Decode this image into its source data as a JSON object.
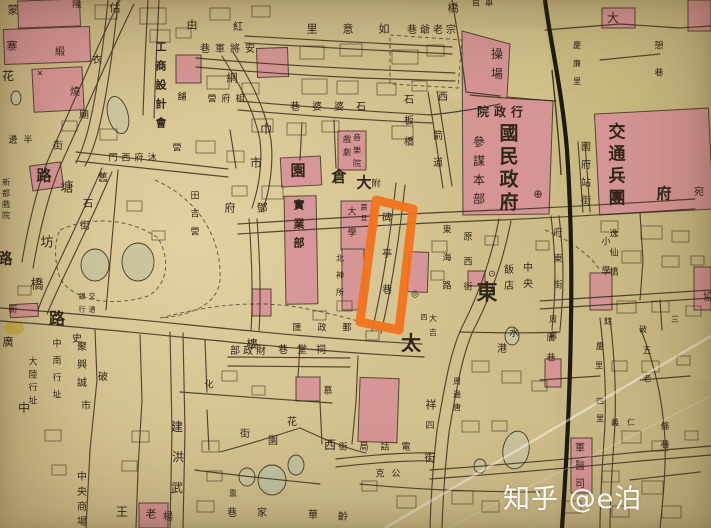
{
  "photo": {
    "kind": "old city map photograph",
    "watermark": {
      "text": "知乎 @e泊",
      "color": "#ffffff"
    }
  },
  "colors": {
    "paper": "#d2c08d",
    "block_pink": "#d98f97",
    "ink": "#30251a",
    "railway": "#1f1a12",
    "highlight": "#f2731d",
    "pond": "#c9c49d"
  },
  "highlight": {
    "shape": "rectangle-outline",
    "color": "#f2731d",
    "points": "376,200 413,209 399,330 360,322",
    "highlights_street": "碑亭巷"
  },
  "labels": [
    {
      "t": "蒙",
      "x": 13,
      "y": 10,
      "s": 11
    },
    {
      "t": "寨",
      "x": 12,
      "y": 46,
      "s": 11
    },
    {
      "t": "花",
      "x": 8,
      "y": 76,
      "s": 12
    },
    {
      "t": "隆",
      "x": 77,
      "y": 5,
      "s": 10
    },
    {
      "t": "緞",
      "x": 60,
      "y": 53,
      "s": 10
    },
    {
      "t": "衣",
      "x": 97,
      "y": 61,
      "s": 10
    },
    {
      "t": "燒",
      "x": 75,
      "y": 93,
      "s": 10
    },
    {
      "t": "廟",
      "x": 84,
      "y": 116,
      "s": 10
    },
    {
      "t": "估",
      "x": 115,
      "y": 8,
      "s": 11
    },
    {
      "t": "由",
      "x": 192,
      "y": 25,
      "s": 11
    },
    {
      "t": "紅",
      "x": 238,
      "y": 28,
      "s": 10
    },
    {
      "t": "里意如",
      "x": 312,
      "y": 29,
      "s": 11,
      "d": "h",
      "st": 36
    },
    {
      "t": "巷爺老宗",
      "x": 412,
      "y": 31,
      "s": 10,
      "d": "h",
      "st": 13
    },
    {
      "t": "橋",
      "x": 453,
      "y": 8,
      "s": 11
    },
    {
      "t": "巷軍將安",
      "x": 205,
      "y": 50,
      "s": 10,
      "d": "h",
      "st": 15
    },
    {
      "t": "舖",
      "x": 182,
      "y": 98,
      "s": 9
    },
    {
      "t": "營府相",
      "x": 212,
      "y": 100,
      "s": 9,
      "d": "h",
      "st": 14
    },
    {
      "t": "工商設計會",
      "x": 161,
      "y": 47,
      "s": 11,
      "d": "v",
      "st": 19,
      "b": 1
    },
    {
      "t": "網",
      "x": 232,
      "y": 78,
      "s": 11
    },
    {
      "t": "巾",
      "x": 266,
      "y": 129,
      "s": 12
    },
    {
      "t": "市",
      "x": 256,
      "y": 163,
      "s": 12
    },
    {
      "t": "門西府沐",
      "x": 113,
      "y": 159,
      "s": 9,
      "d": "h",
      "st": 13
    },
    {
      "t": "營",
      "x": 177,
      "y": 149,
      "s": 9
    },
    {
      "t": "邊半",
      "x": 13,
      "y": 141,
      "s": 9,
      "d": "h",
      "st": 15
    },
    {
      "t": "街",
      "x": 58,
      "y": 147,
      "s": 10
    },
    {
      "t": "路",
      "x": 44,
      "y": 176,
      "s": 15,
      "b": 1
    },
    {
      "t": "塘",
      "x": 67,
      "y": 188,
      "s": 13
    },
    {
      "t": "舊",
      "x": 103,
      "y": 179,
      "s": 10
    },
    {
      "t": "石",
      "x": 88,
      "y": 205,
      "s": 10
    },
    {
      "t": "街",
      "x": 85,
      "y": 227,
      "s": 10
    },
    {
      "t": "坊",
      "x": 47,
      "y": 243,
      "s": 13
    },
    {
      "t": "橋",
      "x": 37,
      "y": 285,
      "s": 13
    },
    {
      "t": "路",
      "x": 5,
      "y": 259,
      "s": 15,
      "b": 1
    },
    {
      "t": "新都戲院",
      "x": 6,
      "y": 183,
      "s": 8,
      "d": "v",
      "st": 11
    },
    {
      "t": "田吉營",
      "x": 195,
      "y": 197,
      "s": 9,
      "d": "v",
      "st": 18
    },
    {
      "t": "府鄧",
      "x": 230,
      "y": 208,
      "s": 11,
      "d": "h",
      "st": 32
    },
    {
      "t": "音樂院",
      "x": 357,
      "y": 138,
      "s": 8,
      "d": "v",
      "st": 13
    },
    {
      "t": "戲劇",
      "x": 347,
      "y": 140,
      "s": 8,
      "d": "v",
      "st": 13
    },
    {
      "t": "石板橋",
      "x": 409,
      "y": 101,
      "s": 10,
      "d": "v",
      "st": 21
    },
    {
      "t": "西",
      "x": 443,
      "y": 98,
      "s": 10
    },
    {
      "t": "箭道",
      "x": 438,
      "y": 137,
      "s": 10,
      "d": "v",
      "st": 27
    },
    {
      "t": "巷婆婆石",
      "x": 295,
      "y": 108,
      "s": 10,
      "d": "h",
      "st": 22
    },
    {
      "t": "園",
      "x": 298,
      "y": 171,
      "s": 15,
      "b": 1
    },
    {
      "t": "倉",
      "x": 339,
      "y": 177,
      "s": 15,
      "b": 1
    },
    {
      "t": "大",
      "x": 364,
      "y": 183,
      "s": 15,
      "b": 1
    },
    {
      "t": "附",
      "x": 376,
      "y": 185,
      "s": 9
    },
    {
      "t": "操場",
      "x": 497,
      "y": 54,
      "s": 12,
      "d": "v",
      "st": 20
    },
    {
      "t": "官軍",
      "x": 476,
      "y": 4,
      "s": 9,
      "d": "h",
      "st": 13
    },
    {
      "t": "院政行",
      "x": 483,
      "y": 112,
      "s": 12,
      "d": "h",
      "st": 17,
      "b": 1
    },
    {
      "t": "國民政府",
      "x": 509,
      "y": 134,
      "s": 19,
      "d": "v",
      "st": 23,
      "b": 1
    },
    {
      "t": "參謀本部",
      "x": 479,
      "y": 142,
      "s": 12,
      "d": "v",
      "st": 19
    },
    {
      "t": "國府站街",
      "x": 586,
      "y": 148,
      "s": 10,
      "d": "v",
      "st": 18
    },
    {
      "t": "交通兵團",
      "x": 617,
      "y": 133,
      "s": 17,
      "d": "v",
      "st": 22,
      "b": 1
    },
    {
      "t": "慶廉里",
      "x": 577,
      "y": 46,
      "s": 8,
      "d": "v",
      "st": 18
    },
    {
      "t": "大",
      "x": 613,
      "y": 18,
      "s": 12
    },
    {
      "t": "憩巷",
      "x": 659,
      "y": 47,
      "s": 9,
      "d": "v",
      "st": 27
    },
    {
      "t": "府",
      "x": 664,
      "y": 194,
      "s": 15,
      "b": 1
    },
    {
      "t": "宛",
      "x": 699,
      "y": 193,
      "s": 10
    },
    {
      "t": "小學",
      "x": 606,
      "y": 243,
      "s": 9,
      "d": "v",
      "st": 29
    },
    {
      "t": "逸仙橋",
      "x": 614,
      "y": 235,
      "s": 9,
      "d": "v",
      "st": 19
    },
    {
      "t": "協",
      "x": 708,
      "y": 298,
      "s": 10
    },
    {
      "t": "東海路",
      "x": 447,
      "y": 231,
      "s": 9,
      "d": "v",
      "st": 28
    },
    {
      "t": "原西街",
      "x": 468,
      "y": 238,
      "s": 9,
      "d": "v",
      "st": 25
    },
    {
      "t": "府東街",
      "x": 558,
      "y": 234,
      "s": 9,
      "d": "v",
      "st": 26
    },
    {
      "t": "中央",
      "x": 528,
      "y": 269,
      "s": 10,
      "d": "v",
      "st": 16
    },
    {
      "t": "飯店",
      "x": 509,
      "y": 271,
      "s": 10,
      "d": "v",
      "st": 16
    },
    {
      "t": "東",
      "x": 487,
      "y": 293,
      "s": 21,
      "b": 1
    },
    {
      "t": "碑亭巷",
      "x": 387,
      "y": 219,
      "s": 10,
      "d": "v",
      "st": 36
    },
    {
      "t": "震旦",
      "x": 364,
      "y": 208,
      "s": 7,
      "d": "v",
      "st": 11
    },
    {
      "t": "大學",
      "x": 352,
      "y": 213,
      "s": 9,
      "d": "v",
      "st": 21
    },
    {
      "t": "北神所",
      "x": 340,
      "y": 259,
      "s": 8,
      "d": "v",
      "st": 17
    },
    {
      "t": "實業部",
      "x": 299,
      "y": 205,
      "s": 11,
      "d": "v",
      "st": 19,
      "b": 1
    },
    {
      "t": "四",
      "x": 424,
      "y": 318,
      "s": 7
    },
    {
      "t": "大吉",
      "x": 433,
      "y": 319,
      "s": 8,
      "d": "v",
      "st": 14
    },
    {
      "t": "周處",
      "x": 553,
      "y": 320,
      "s": 8,
      "d": "v",
      "st": 16
    },
    {
      "t": "水",
      "x": 514,
      "y": 334,
      "s": 10
    },
    {
      "t": "港",
      "x": 502,
      "y": 350,
      "s": 10
    },
    {
      "t": "唐巷",
      "x": 551,
      "y": 339,
      "s": 9,
      "d": "v",
      "st": 20
    },
    {
      "t": "餘",
      "x": 608,
      "y": 322,
      "s": 8
    },
    {
      "t": "慶",
      "x": 600,
      "y": 347,
      "s": 8
    },
    {
      "t": "里",
      "x": 599,
      "y": 366,
      "s": 8
    },
    {
      "t": "四里",
      "x": 600,
      "y": 402,
      "s": 8,
      "d": "v",
      "st": 17
    },
    {
      "t": "義仁",
      "x": 615,
      "y": 423,
      "s": 8,
      "d": "h",
      "st": 16
    },
    {
      "t": "五老",
      "x": 647,
      "y": 352,
      "s": 9,
      "d": "v",
      "st": 28
    },
    {
      "t": "破",
      "x": 643,
      "y": 330,
      "s": 8
    },
    {
      "t": "三",
      "x": 675,
      "y": 320,
      "s": 8
    },
    {
      "t": "條巷",
      "x": 665,
      "y": 428,
      "s": 9,
      "d": "v",
      "st": 18
    },
    {
      "t": "軍醫司",
      "x": 580,
      "y": 449,
      "s": 10,
      "d": "v",
      "st": 18
    },
    {
      "t": "祥",
      "x": 431,
      "y": 405,
      "s": 11
    },
    {
      "t": "四",
      "x": 430,
      "y": 427,
      "s": 9
    },
    {
      "t": "街",
      "x": 430,
      "y": 458,
      "s": 11
    },
    {
      "t": "太",
      "x": 411,
      "y": 343,
      "s": 20,
      "b": 1
    },
    {
      "t": "周邊唐",
      "x": 457,
      "y": 382,
      "s": 8,
      "d": "v",
      "st": 13
    },
    {
      "t": "樓",
      "x": 252,
      "y": 344,
      "s": 11
    },
    {
      "t": "部政財",
      "x": 235,
      "y": 352,
      "s": 10,
      "d": "h",
      "st": 13
    },
    {
      "t": "匯政郵",
      "x": 297,
      "y": 329,
      "s": 9,
      "d": "h",
      "st": 25
    },
    {
      "t": "巷堂祠",
      "x": 283,
      "y": 351,
      "s": 10,
      "d": "h",
      "st": 19
    },
    {
      "t": "化",
      "x": 209,
      "y": 386,
      "s": 9
    },
    {
      "t": "慕",
      "x": 328,
      "y": 392,
      "s": 9
    },
    {
      "t": "街",
      "x": 245,
      "y": 435,
      "s": 10
    },
    {
      "t": "園",
      "x": 273,
      "y": 442,
      "s": 10
    },
    {
      "t": "花",
      "x": 292,
      "y": 423,
      "s": 10
    },
    {
      "t": "西",
      "x": 330,
      "y": 445,
      "s": 12
    },
    {
      "t": "街局話電",
      "x": 343,
      "y": 448,
      "s": 9,
      "d": "h",
      "st": 21
    },
    {
      "t": "克公",
      "x": 380,
      "y": 475,
      "s": 9,
      "d": "h",
      "st": 16
    },
    {
      "t": "熏",
      "x": 233,
      "y": 494,
      "s": 8
    },
    {
      "t": "巷",
      "x": 232,
      "y": 514,
      "s": 10
    },
    {
      "t": "家",
      "x": 262,
      "y": 514,
      "s": 10
    },
    {
      "t": "華",
      "x": 313,
      "y": 516,
      "s": 10
    },
    {
      "t": "齡",
      "x": 343,
      "y": 518,
      "s": 10
    },
    {
      "t": "路",
      "x": 57,
      "y": 319,
      "s": 16,
      "b": 1
    },
    {
      "t": "史",
      "x": 77,
      "y": 340,
      "s": 10
    },
    {
      "t": "廣",
      "x": 8,
      "y": 342,
      "s": 11
    },
    {
      "t": "聚興誠",
      "x": 82,
      "y": 348,
      "s": 10,
      "d": "v",
      "st": 18
    },
    {
      "t": "中南行址",
      "x": 57,
      "y": 345,
      "s": 9,
      "d": "v",
      "st": 17
    },
    {
      "t": "大陸行址",
      "x": 33,
      "y": 363,
      "s": 9,
      "d": "v",
      "st": 13
    },
    {
      "t": "中",
      "x": 24,
      "y": 408,
      "s": 12
    },
    {
      "t": "破",
      "x": 103,
      "y": 378,
      "s": 10
    },
    {
      "t": "市",
      "x": 86,
      "y": 407,
      "s": 10
    },
    {
      "t": "中央商場",
      "x": 82,
      "y": 478,
      "s": 10,
      "d": "v",
      "st": 15
    },
    {
      "t": "王",
      "x": 122,
      "y": 512,
      "s": 12
    },
    {
      "t": "老",
      "x": 151,
      "y": 514,
      "s": 11
    },
    {
      "t": "楊",
      "x": 168,
      "y": 518,
      "s": 10
    },
    {
      "t": "建",
      "x": 177,
      "y": 427,
      "s": 12
    },
    {
      "t": "洪",
      "x": 178,
      "y": 457,
      "s": 12
    },
    {
      "t": "武",
      "x": 177,
      "y": 488,
      "s": 12
    },
    {
      "t": "銀交",
      "x": 82,
      "y": 297,
      "s": 7,
      "d": "h",
      "st": 10
    },
    {
      "t": "行通",
      "x": 82,
      "y": 310,
      "s": 7,
      "d": "h",
      "st": 10
    },
    {
      "t": "新",
      "x": 13,
      "y": 311,
      "s": 9
    },
    {
      "t": "⊕",
      "x": 538,
      "y": 194,
      "s": 11
    },
    {
      "t": "◎",
      "x": 415,
      "y": 295,
      "s": 9
    },
    {
      "t": "⊙",
      "x": 492,
      "y": 275,
      "s": 9
    },
    {
      "t": "✕",
      "x": 40,
      "y": 74,
      "s": 8
    }
  ]
}
